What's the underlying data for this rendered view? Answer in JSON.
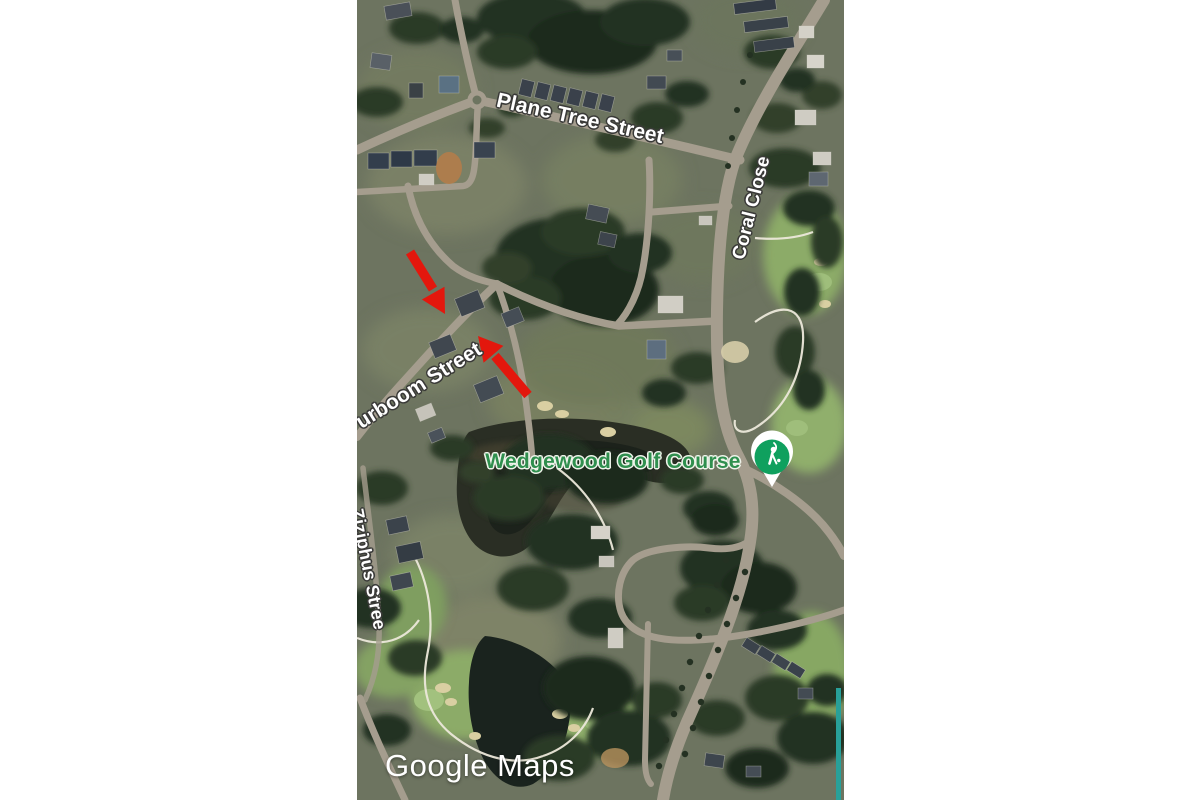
{
  "window": {
    "background_color": "#ffffff"
  },
  "map": {
    "provider": "Google Maps",
    "view_type": "satellite",
    "street_labels": [
      {
        "id": "plane-tree-street",
        "text": "Plane Tree Street"
      },
      {
        "id": "coral-close",
        "text": "Coral Close"
      },
      {
        "id": "keurboom-street",
        "text": "urboom Street"
      },
      {
        "id": "ziziphus-street",
        "text": "Ziziphus Stree"
      }
    ],
    "poi_label": {
      "text": "Wedgewood Golf Course",
      "color": "#2f8f4e"
    },
    "marker": {
      "name": "golf-course-pin",
      "icon": "golfer-icon",
      "color": "#0fa05e",
      "halo": "#ffffff"
    },
    "annotations": {
      "color": "#e3170d",
      "items": [
        {
          "id": "arrow-1",
          "description": "red arrow pointing down-right at house on street bend"
        },
        {
          "id": "arrow-2",
          "description": "red arrow pointing up-left at road corner"
        }
      ]
    },
    "watermark": {
      "text": "Google Maps",
      "color": "#ffffff"
    },
    "colors": {
      "ground": "#6d7460",
      "road": "#a59d8e",
      "vegetation": "#233123",
      "fairway": "#8cab68",
      "water": "#1a231e",
      "sand": "#d9cfa2",
      "teal_edge": "#28a099"
    }
  }
}
